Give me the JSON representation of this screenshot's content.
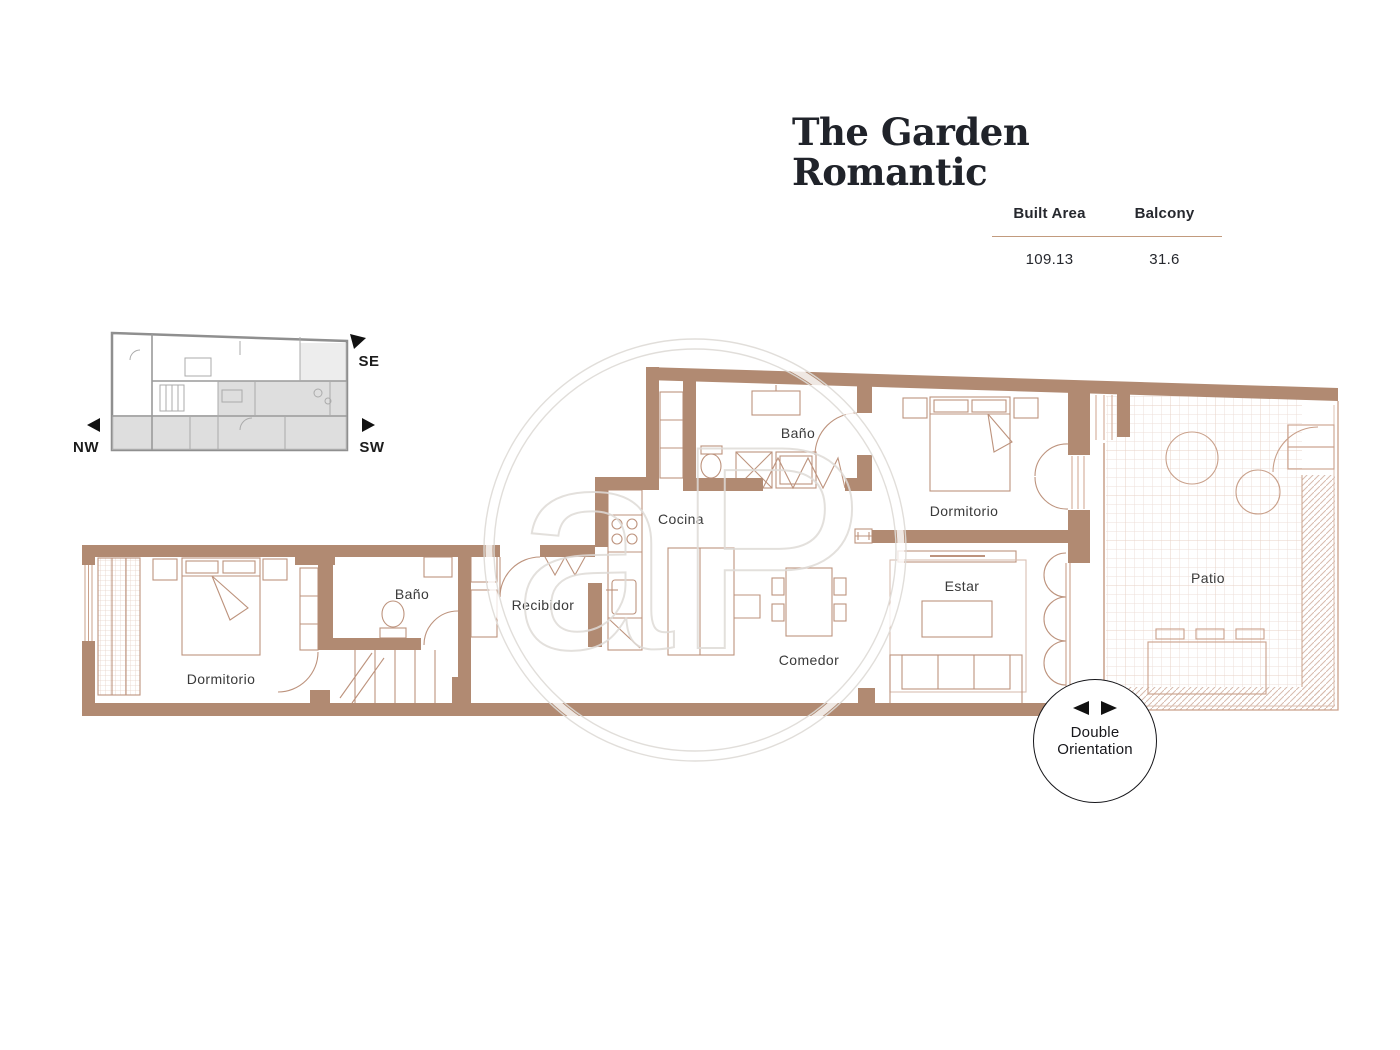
{
  "header": {
    "title_line1": "The Garden",
    "title_line2": "Romantic"
  },
  "stats": {
    "columns": [
      {
        "label": "Built Area",
        "value": "109.13"
      },
      {
        "label": "Balcony",
        "value": "31.6"
      }
    ]
  },
  "compass": {
    "se": "SE",
    "nw": "NW",
    "sw": "SW"
  },
  "badge": {
    "line1": "Double",
    "line2": "Orientation"
  },
  "rooms": {
    "bano_top": "Baño",
    "dormitorio_right": "Dormitorio",
    "cocina": "Cocina",
    "recibidor": "Recibidor",
    "comedor": "Comedor",
    "estar": "Estar",
    "patio": "Patio",
    "dormitorio_left": "Dormitorio",
    "bano_left": "Baño"
  },
  "watermark": {
    "letters": "aP"
  },
  "colors": {
    "wall": "#b18a72",
    "line": "#bd937d",
    "label": "#3a3a3a",
    "rule": "#c29b7e"
  }
}
